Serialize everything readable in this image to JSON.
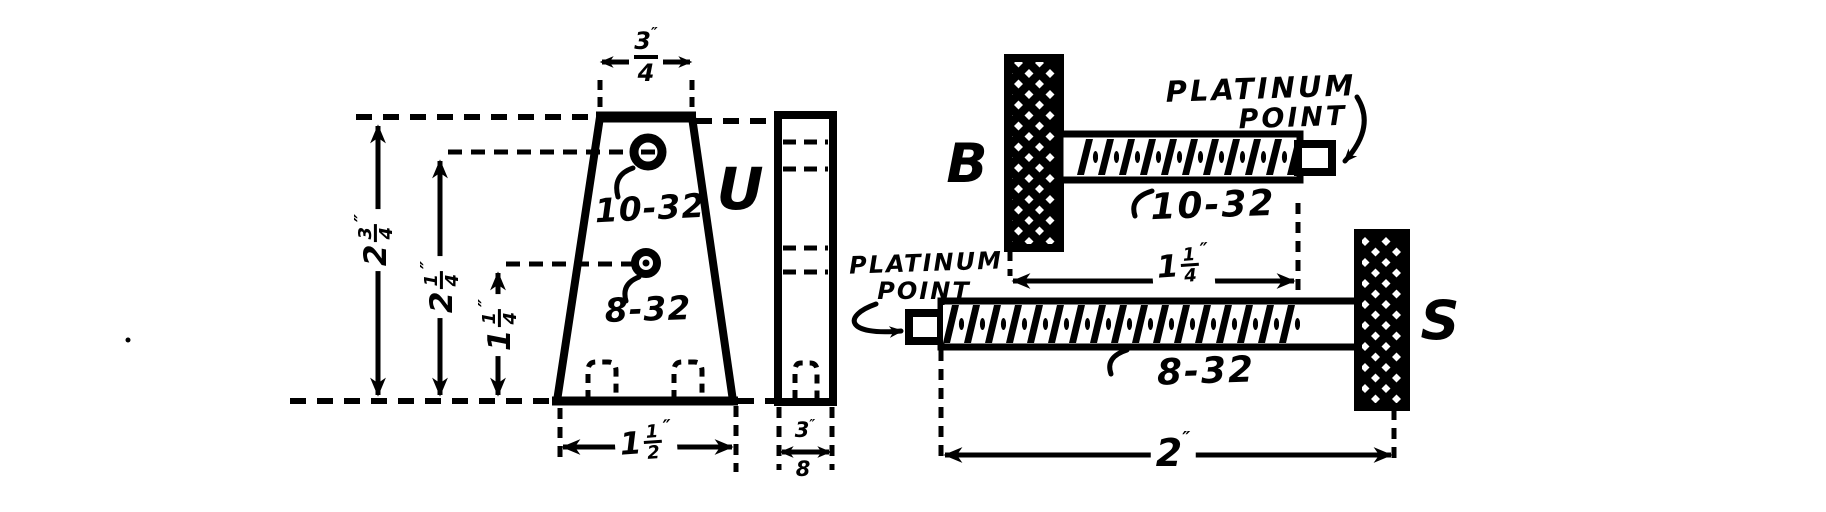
{
  "front_view": {
    "part_label": "U",
    "top_hole_label": "10-32",
    "bottom_hole_label": "8-32",
    "dims": {
      "top_width": {
        "num": "3",
        "den": "4",
        "unit": "″"
      },
      "overall_height": {
        "whole": "2",
        "num": "3",
        "den": "4",
        "unit": "″"
      },
      "top_hole_height": {
        "whole": "2",
        "num": "1",
        "den": "4",
        "unit": "″"
      },
      "bottom_hole_height": {
        "whole": "1",
        "num": "1",
        "den": "4",
        "unit": "″"
      },
      "bottom_width": {
        "whole": "1",
        "num": "1",
        "den": "2",
        "unit": "″"
      },
      "thickness": {
        "num": "3",
        "den": "8",
        "unit": "″"
      }
    }
  },
  "screw_b": {
    "part_label": "B",
    "thread_label": "10-32",
    "callout_line1": "PLATINUM",
    "callout_line2": "POINT",
    "length_dim": {
      "whole": "1",
      "num": "1",
      "den": "4",
      "unit": "″"
    }
  },
  "screw_s": {
    "part_label": "S",
    "thread_label": "8-32",
    "callout_line1": "PLATINUM",
    "callout_line2": "POINT",
    "length_dim": {
      "whole": "2",
      "unit": "″"
    }
  },
  "colors": {
    "ink": "#000000",
    "paper": "#ffffff"
  }
}
